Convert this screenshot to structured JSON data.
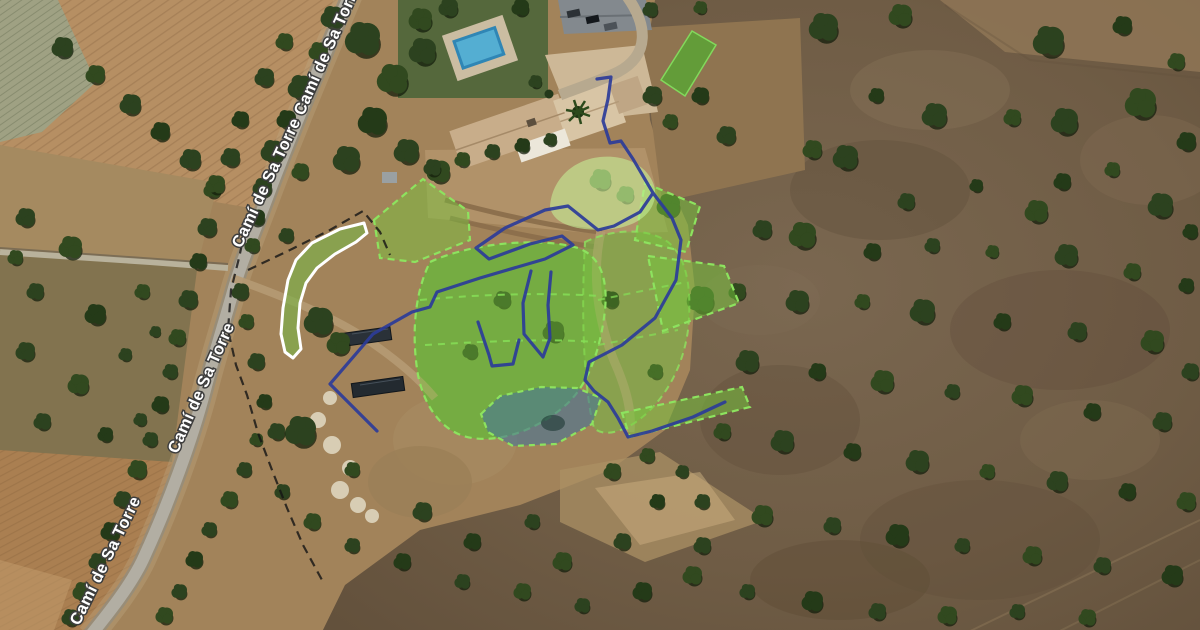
{
  "map": {
    "imagery": "satellite",
    "road": {
      "name": "Camí de Sa Torre"
    },
    "road_labels": [
      {
        "text": "Camí de Sa Torre"
      },
      {
        "text": "Camí de Sa Torre"
      },
      {
        "text": "Camí de Sa Torre"
      },
      {
        "text": "Camí de Sa Torre"
      }
    ]
  },
  "overlays": {
    "palette": {
      "zone_fill": "#76c83c",
      "zone_stroke": "#8de35f",
      "path_blue": "#2c3c99",
      "pond_fill": "#497494",
      "boundary_black": "#141414",
      "white_outline": "#ffffff"
    },
    "zones": {
      "house_garden_bed": {
        "points": "374,220 423,179 468,211 470,240 415,262 380,258"
      },
      "main_circle": {
        "d": "M 430,262 C 468,244 538,236 578,248 C 600,256 608,278 605,310 C 601,346 590,381 569,402 C 544,426 505,443 472,438 C 445,434 425,410 418,375 C 412,340 413,296 430,262 Z"
      },
      "east_wash": {
        "d": "M 585,242 C 610,230 645,226 668,242 C 688,258 692,292 688,330 C 683,368 664,402 636,422 C 618,434 602,436 594,428 C 586,400 580,330 585,242 Z"
      },
      "parcel_upper": {
        "points": "645,183 700,206 686,252 635,240"
      },
      "parcel_lower": {
        "points": "648,256 724,266 739,303 663,331"
      },
      "parcel_strip": {
        "points": "622,413 742,387 750,407 630,437"
      },
      "top_parallelogram": {
        "points": "692,31 716,45 685,96 661,80"
      },
      "canopy_blob": {
        "d": "M 550,206 C 552,180 572,160 600,157 C 630,154 652,170 655,190 C 657,210 640,226 612,229 C 582,232 552,226 550,206 Z"
      },
      "row_line_1": {
        "d": "M 420,300 C 470,295 540,292 600,296"
      },
      "row_line_2": {
        "d": "M 425,345 C 475,342 545,338 596,342"
      },
      "row_line_3": {
        "d": "M 598,300 L 686,282"
      },
      "row_line_4": {
        "d": "M 598,345 L 678,330"
      }
    },
    "white_path_bed": {
      "d": "M 364,223 L 340,229 L 312,243 L 296,260 L 288,280 L 283,308 L 281,334 L 285,352 L 293,358 L 301,349 L 298,328 L 300,303 L 306,283 L 317,268 L 335,254 L 356,242 L 367,233 Z"
    },
    "pond": {
      "points": "481,414 500,396 541,387 577,388 601,398 592,424 556,444 513,446 488,432"
    },
    "paths": {
      "main_loop": {
        "d": "M 597,79 L 611,77 L 608,99 L 603,121 L 610,143 L 621,141 L 633,159 L 653,193 L 640,212 L 614,226 L 598,230 L 568,206 L 545,210 L 505,228 L 476,248 L 489,259 L 530,244 L 562,236 L 573,245 L 545,259 L 480,278 L 437,292 L 430,307 L 412,312 L 373,334 L 330,384 L 377,431"
      },
      "east_branch": {
        "d": "M 653,193 L 672,218 L 681,240 L 676,280 L 655,318 L 622,345 L 589,362 L 585,380 L 594,391 L 608,402 L 618,418 L 628,437 L 652,431 L 693,417 L 725,402"
      },
      "beds_inner_1": {
        "d": "M 531,271 L 523,303 L 524,334 L 543,357 L 550,338 L 548,305 L 551,272"
      },
      "beds_inner_2": {
        "d": "M 478,322 L 489,355 L 492,366 L 513,364 L 519,340"
      }
    },
    "boundary": {
      "along_road": {
        "d": "M 245,230 L 239,258 L 231,290 L 228,330 L 236,365 L 247,395 L 258,433 L 272,470 L 287,508 L 303,545 L 322,580"
      },
      "to_garden": {
        "d": "M 248,270 L 290,250 L 330,230 L 363,211 L 380,232 L 390,255"
      }
    }
  }
}
